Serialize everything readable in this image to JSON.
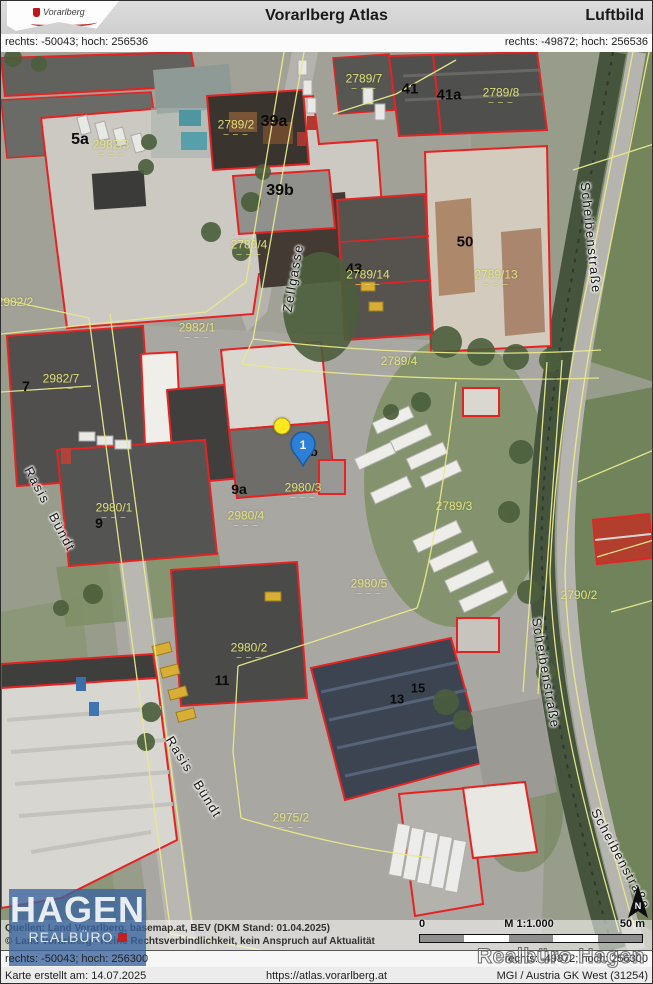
{
  "header": {
    "logo_text": "Vorarlberg",
    "title": "Vorarlberg Atlas",
    "subtitle": "Luftbild"
  },
  "coords": {
    "top_left": "rechts: -50043; hoch: 256536",
    "top_right": "rechts: -49872; hoch: 256536",
    "bottom_left": "rechts: -50043; hoch: 256300",
    "bottom_right": "rechts: -49872; hoch: 256300"
  },
  "footer": {
    "created": "Karte erstellt am: 14.07.2025",
    "url": "https://atlas.vorarlberg.at",
    "crs": "MGI / Austria GK West (31254)"
  },
  "attribution": {
    "line1": "Quellen: Land Vorarlberg, basemap.at, BEV (DKM Stand: 01.04.2025)",
    "line2": "© Land Vorarlberg - Keine Rechtsverbindlichkeit, kein Anspruch auf Aktualität"
  },
  "scalebar": {
    "zero": "0",
    "scale": "M 1:1.000",
    "max": "50 m"
  },
  "north_label": "N",
  "watermark": "Realbüro Hagen",
  "hagen_logo": {
    "name": "HAGEN",
    "subtitle": "REALBÜRO"
  },
  "colors": {
    "parcel_outline": "#e62222",
    "cadastre_line": "#e9e98c",
    "marker_pin": "#2e7fd8",
    "marker_dot": "#ffe81e"
  },
  "map": {
    "dash_glyph": "– – –",
    "house_labels": [
      {
        "text": "5a",
        "x": 79,
        "y": 88,
        "size": 16
      },
      {
        "text": "39a",
        "x": 273,
        "y": 70,
        "size": 16
      },
      {
        "text": "39b",
        "x": 279,
        "y": 139,
        "size": 16
      },
      {
        "text": "41",
        "x": 409,
        "y": 37,
        "size": 15
      },
      {
        "text": "41a",
        "x": 448,
        "y": 43,
        "size": 15
      },
      {
        "text": "43",
        "x": 353,
        "y": 217,
        "size": 15
      },
      {
        "text": "50",
        "x": 464,
        "y": 190,
        "size": 15
      },
      {
        "text": "7",
        "x": 25,
        "y": 334,
        "size": 14
      },
      {
        "text": "9",
        "x": 98,
        "y": 471,
        "size": 14
      },
      {
        "text": "9a",
        "x": 238,
        "y": 437,
        "size": 14
      },
      {
        "text": "b",
        "x": 313,
        "y": 400,
        "size": 12
      },
      {
        "text": "11",
        "x": 221,
        "y": 628,
        "size": 14
      },
      {
        "text": "13",
        "x": 396,
        "y": 647,
        "size": 13
      },
      {
        "text": "15",
        "x": 417,
        "y": 636,
        "size": 13
      }
    ],
    "parcel_labels": [
      {
        "text": "2982/3",
        "x": 110,
        "y": 96,
        "dashes": true
      },
      {
        "text": "2789/2",
        "x": 235,
        "y": 76,
        "dashes": true
      },
      {
        "text": "2789/7",
        "x": 363,
        "y": 30,
        "dashes": true
      },
      {
        "text": "2789/8",
        "x": 500,
        "y": 44,
        "dashes": true
      },
      {
        "text": "2789/14",
        "x": 367,
        "y": 226,
        "dashes": true
      },
      {
        "text": "2789/13",
        "x": 495,
        "y": 226,
        "dashes": true
      },
      {
        "text": "2780/4",
        "x": 248,
        "y": 196,
        "dashes": true
      },
      {
        "text": "2982/2",
        "x": 14,
        "y": 250,
        "dashes": false
      },
      {
        "text": "2982/1",
        "x": 196,
        "y": 279,
        "dashes": true
      },
      {
        "text": "2982/7",
        "x": 60,
        "y": 330,
        "dashes": true
      },
      {
        "text": "2980/1",
        "x": 113,
        "y": 459,
        "dashes": true
      },
      {
        "text": "2980/3",
        "x": 302,
        "y": 439,
        "dashes": true
      },
      {
        "text": "2980/4",
        "x": 245,
        "y": 467,
        "dashes": true
      },
      {
        "text": "2980/5",
        "x": 368,
        "y": 535,
        "dashes": true
      },
      {
        "text": "2980/2",
        "x": 248,
        "y": 599,
        "dashes": true
      },
      {
        "text": "2975/2",
        "x": 290,
        "y": 769,
        "dashes": true
      },
      {
        "text": "2789/4",
        "x": 398,
        "y": 309,
        "dashes": false
      },
      {
        "text": "2789/3",
        "x": 453,
        "y": 454,
        "dashes": false
      },
      {
        "text": "2790/2",
        "x": 578,
        "y": 543,
        "dashes": false
      }
    ],
    "street_labels": [
      {
        "text": "Zellgasse",
        "x": 292,
        "y": 226,
        "rot": -80
      },
      {
        "text": "Rasis Bündt",
        "x": 49,
        "y": 457,
        "rot": 62
      },
      {
        "text": "Rasis Bündt",
        "x": 193,
        "y": 725,
        "rot": 58
      },
      {
        "text": "Scheibenstraße",
        "x": 590,
        "y": 186,
        "rot": 84
      },
      {
        "text": "Scheibenstraße",
        "x": 545,
        "y": 621,
        "rot": 80
      },
      {
        "text": "Scheibenstraße",
        "x": 620,
        "y": 807,
        "rot": 62
      }
    ],
    "markers": {
      "dot": {
        "x": 281,
        "y": 374
      },
      "pin": {
        "x": 302,
        "y": 392,
        "label": "1"
      }
    }
  }
}
